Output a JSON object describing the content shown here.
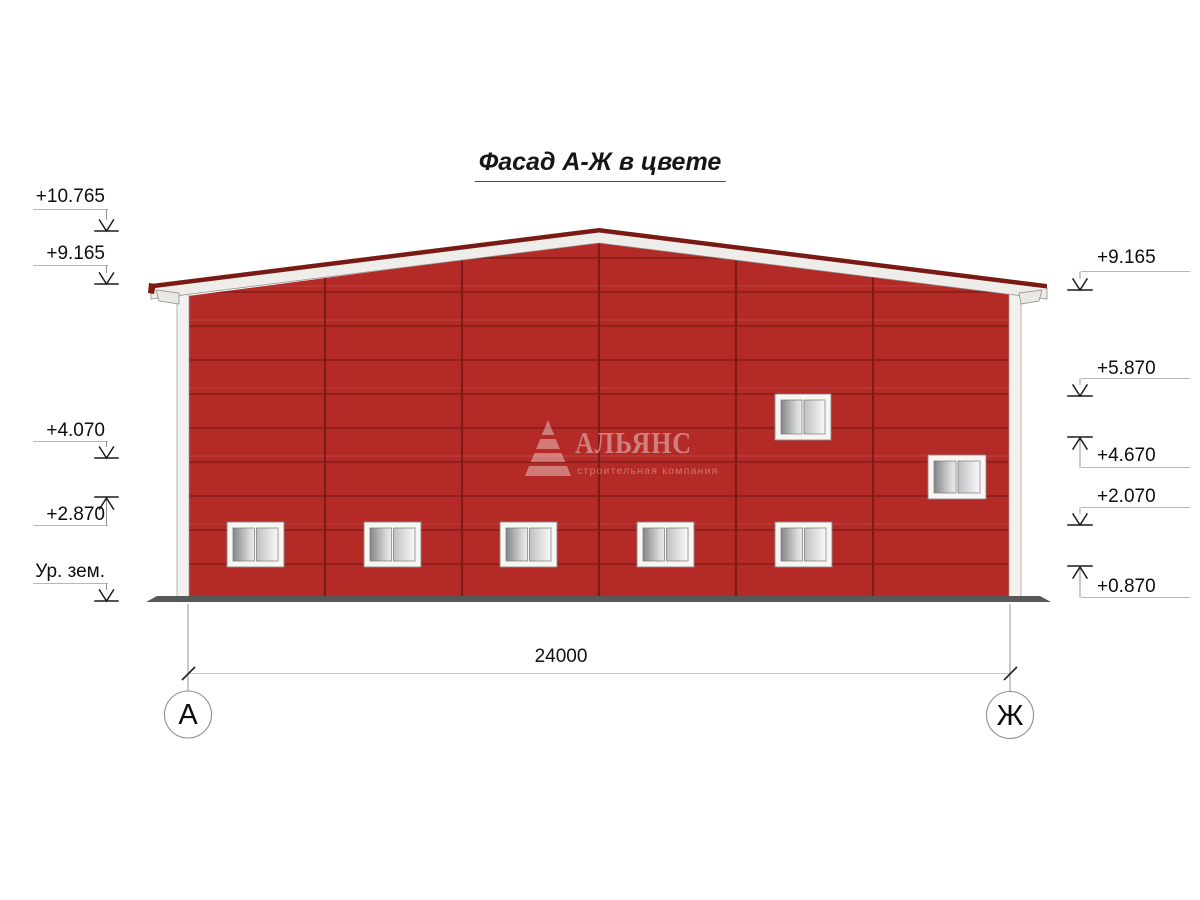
{
  "title": "Фасад А-Ж в цвете",
  "elevations": {
    "left": [
      {
        "label": "+10.765",
        "direction": "down"
      },
      {
        "label": "+9.165",
        "direction": "down"
      },
      {
        "label": "+4.070",
        "direction": "down"
      },
      {
        "label": "+2.870",
        "direction": "up"
      },
      {
        "label": "Ур. зем.",
        "direction": "down"
      }
    ],
    "right": [
      {
        "label": "+9.165",
        "direction": "down"
      },
      {
        "label": "+5.870",
        "direction": "down"
      },
      {
        "label": "+4.670",
        "direction": "up"
      },
      {
        "label": "+2.070",
        "direction": "down"
      },
      {
        "label": "+0.870",
        "direction": "up"
      }
    ]
  },
  "dimension": {
    "total_width": "24000"
  },
  "axes": {
    "left_label": "А",
    "right_label": "Ж"
  },
  "watermark": {
    "company": "АЛЬЯНС",
    "tagline": "строительная компания"
  },
  "building": {
    "wall_color": "#B32A26",
    "panel_joint_color": "#7C1B17",
    "ridge_color": "#7A1A15",
    "fascia_color": "#EEEDE9",
    "ground_color": "#57585A",
    "panel_columns": 6,
    "windows_count": 7
  }
}
